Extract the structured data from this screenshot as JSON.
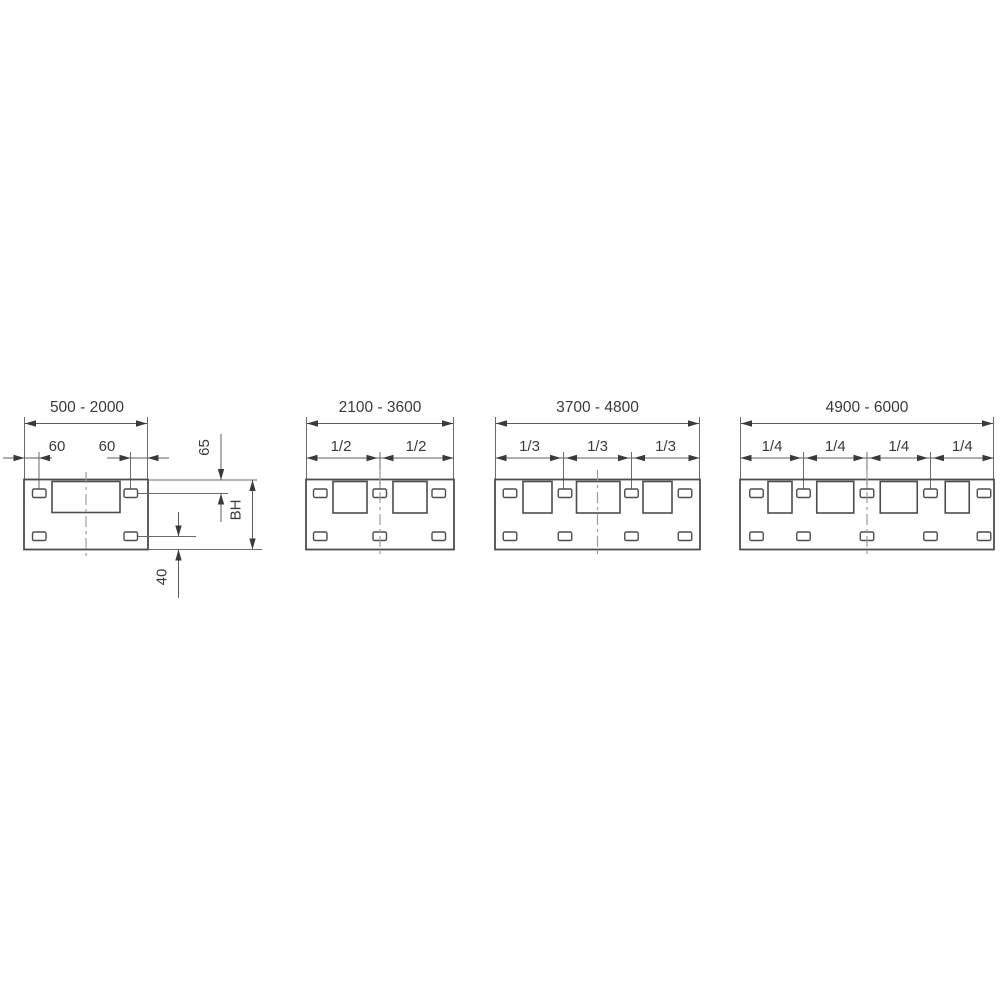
{
  "panels": [
    {
      "range_label": "500 - 2000",
      "sub_labels": [
        "60",
        "60"
      ],
      "side_labels": {
        "top_offset": "65",
        "height": "BH",
        "bottom_offset": "40"
      }
    },
    {
      "range_label": "2100 - 3600",
      "sub_labels": [
        "1/2",
        "1/2"
      ]
    },
    {
      "range_label": "3700 - 4800",
      "sub_labels": [
        "1/3",
        "1/3",
        "1/3"
      ]
    },
    {
      "range_label": "4900 - 6000",
      "sub_labels": [
        "1/4",
        "1/4",
        "1/4",
        "1/4"
      ]
    }
  ],
  "colors": {
    "line": "#4d4d4d",
    "dimension_line": "#5c5c5c",
    "text": "#3a3a3a",
    "centerline": "#9e9e9e",
    "background": "#ffffff"
  }
}
